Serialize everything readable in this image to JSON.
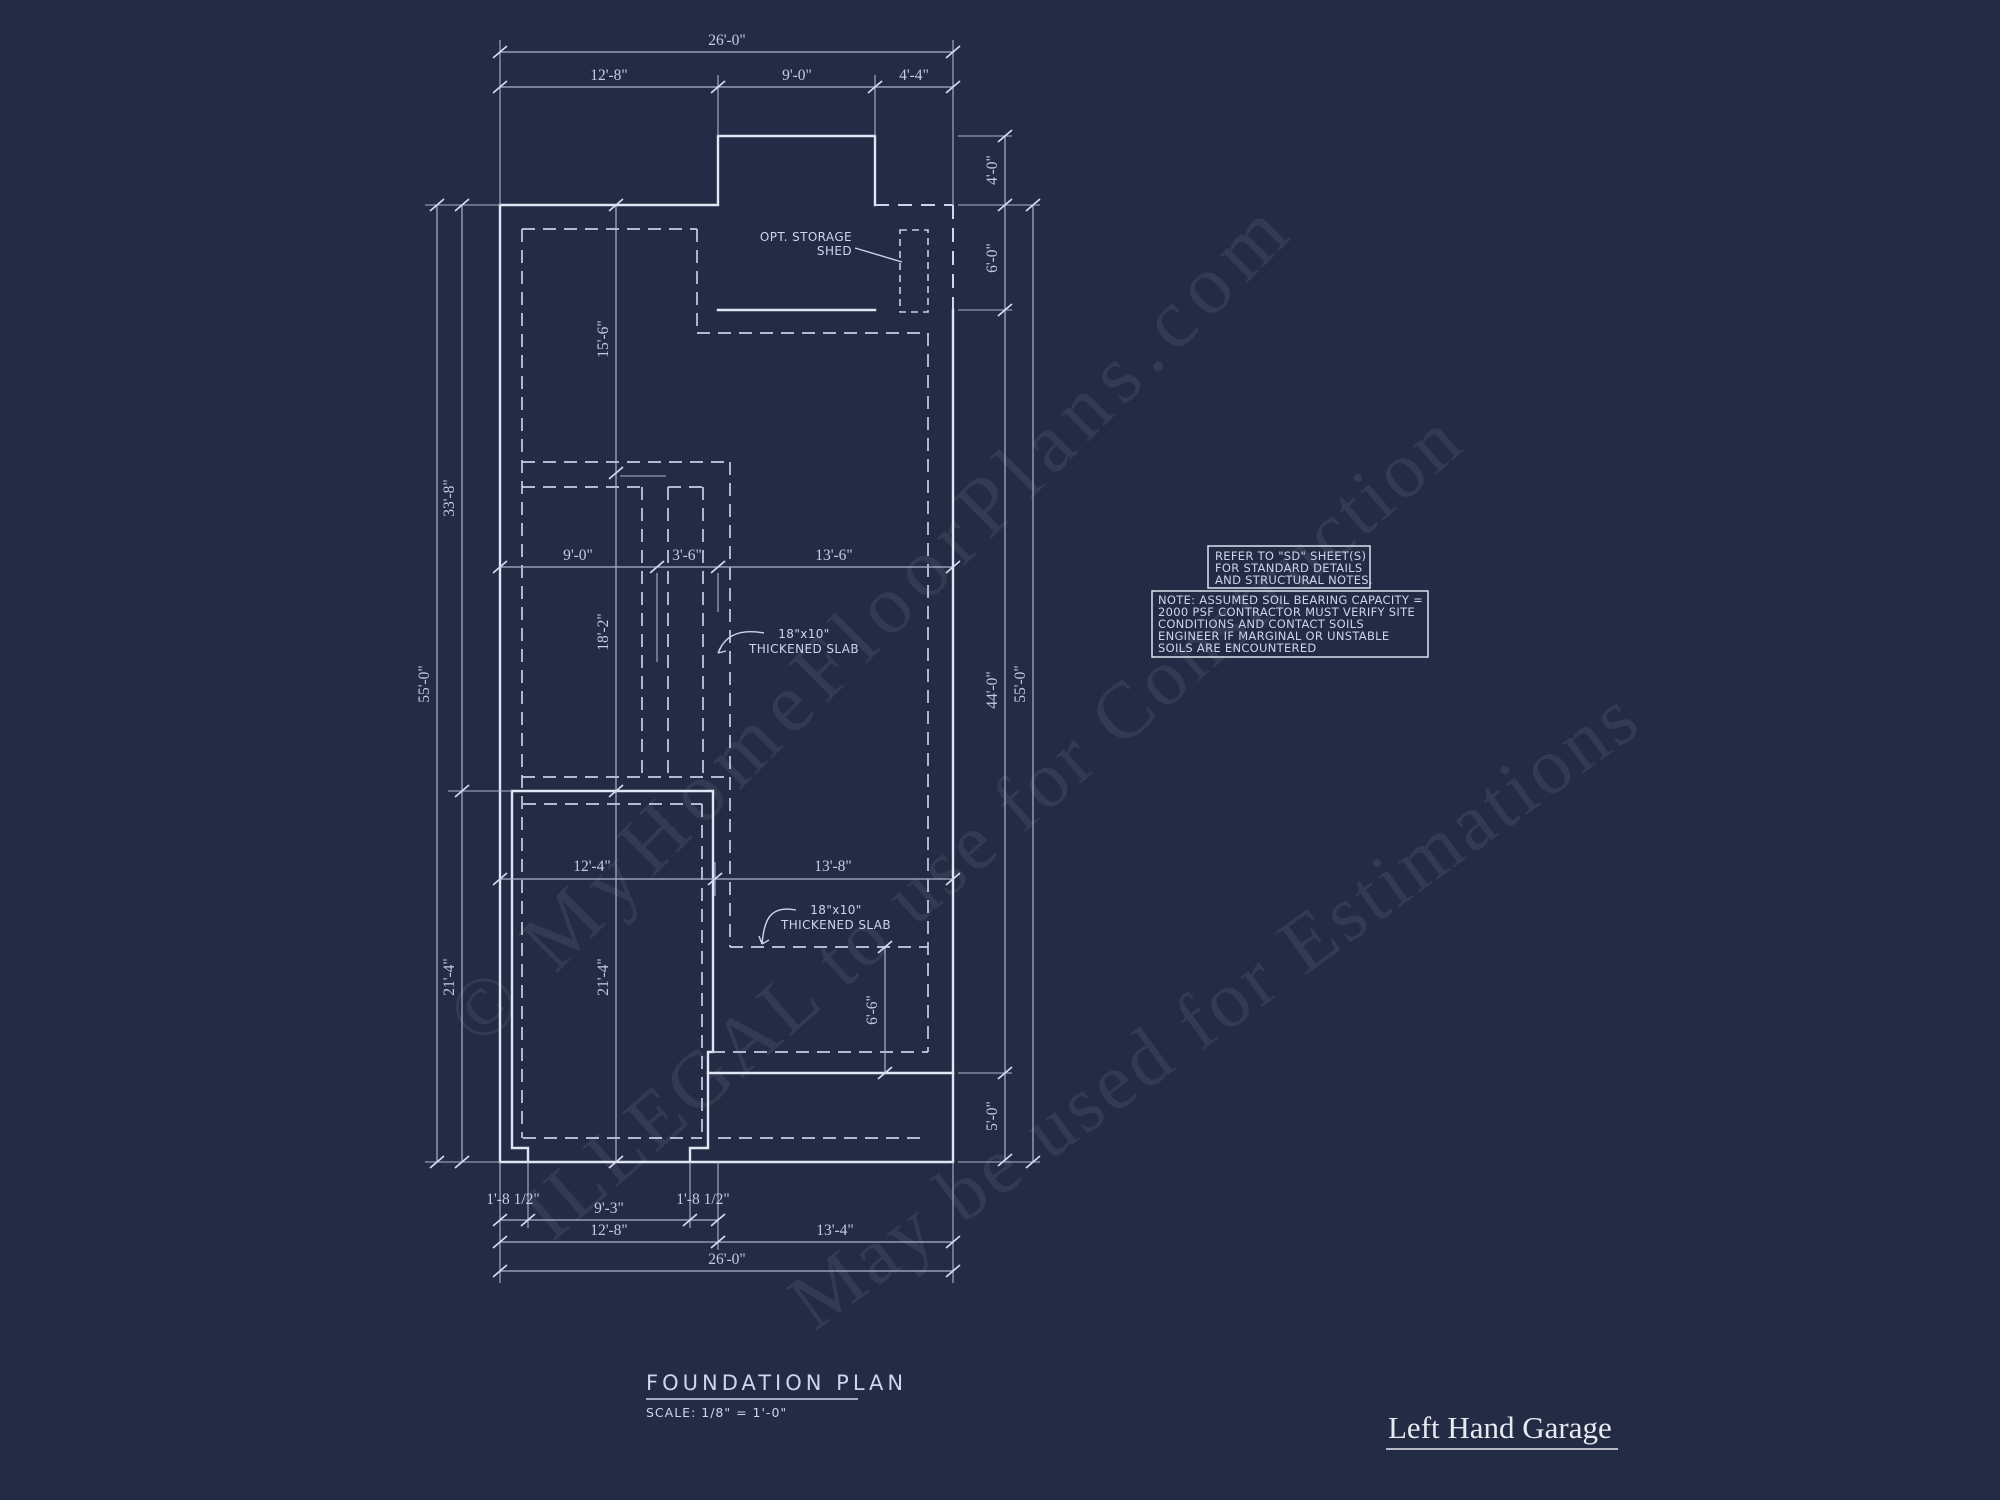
{
  "canvas": {
    "width": 2000,
    "height": 1500,
    "background": "#242b44"
  },
  "colors": {
    "wall_line": "#e0e6f4",
    "dashed_footing": "#c6cfe6",
    "dimension_line": "#a9b5d2",
    "dimension_text": "#c3cde2",
    "note_text": "#ccd6ec",
    "sheet_label_text": "#e8eaf2",
    "watermark": "rgba(255,255,255,0.075)"
  },
  "plan": {
    "labels": {
      "storage_shed_line1": "OPT. STORAGE",
      "storage_shed_line2": "SHED",
      "slab1_line1": "18\"x10\"",
      "slab1_line2": "THICKENED SLAB",
      "slab2_line1": "18\"x10\"",
      "slab2_line2": "THICKENED SLAB"
    },
    "dims": {
      "top_overall": "26'-0\"",
      "top_left": "12'-8\"",
      "top_mid": "9'-0\"",
      "top_right": "4'-4\"",
      "shed_height": "4'-0\"",
      "shed_depth": "6'-0\"",
      "right_main": "44'-0\"",
      "right_stoop": "5'-0\"",
      "right_overall": "55'-0\"",
      "left_overall": "55'-0\"",
      "left_upper": "33'-8\"",
      "left_lower": "21'-4\"",
      "inner_upper": "15'-6\"",
      "inner_mid": "18'-2\"",
      "inner_lower": "21'-4\"",
      "mid_left": "9'-0\"",
      "mid_center": "3'-6\"",
      "mid_right": "13'-6\"",
      "garage_width": "12'-4\"",
      "stoop_width": "13'-8\"",
      "stoop_depth": "6'-6\"",
      "pier_left": "1'-8 1/2\"",
      "door_width": "9'-3\"",
      "pier_right": "1'-8 1/2\"",
      "bottom_left": "12'-8\"",
      "bottom_right": "13'-4\"",
      "bottom_overall": "26'-0\""
    }
  },
  "notes": {
    "refer": [
      "REFER TO \"SD\" SHEET(S)",
      "FOR STANDARD DETAILS",
      "AND STRUCTURAL NOTES."
    ],
    "soil": [
      "NOTE: ASSUMED SOIL BEARING CAPACITY =",
      "2000 PSF CONTRACTOR MUST VERIFY SITE",
      "CONDITIONS AND CONTACT SOILS",
      "ENGINEER IF MARGINAL OR UNSTABLE",
      "SOILS ARE ENCOUNTERED"
    ]
  },
  "title_block": {
    "title": "FOUNDATION PLAN",
    "scale": "SCALE: 1/8\" = 1'-0\""
  },
  "sheet_label": "Left Hand Garage",
  "watermark": {
    "line1": "© MyHomeFloorPlans.com",
    "line2": "ILLEGAL to use for Construction",
    "line3": "May be used for Estimations"
  }
}
